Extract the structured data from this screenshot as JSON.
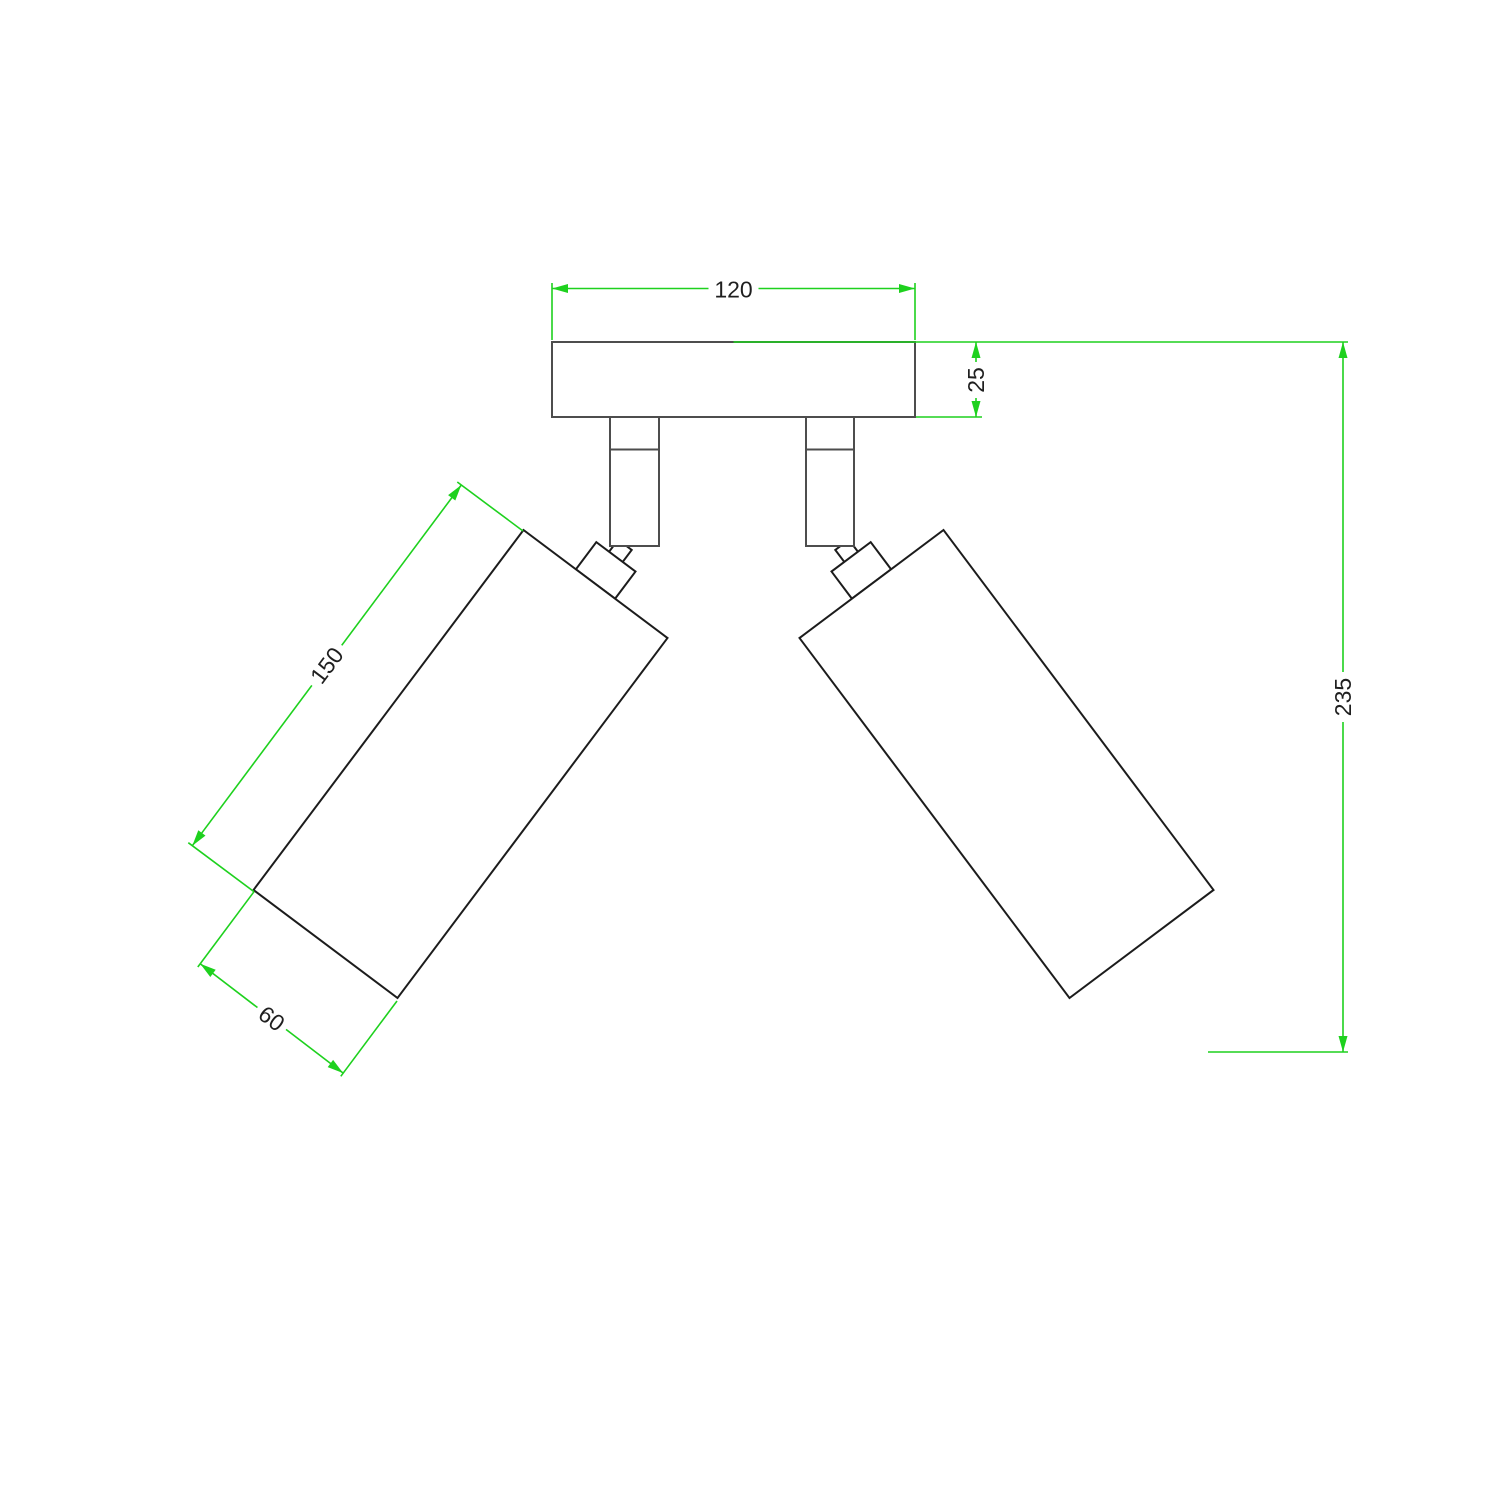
{
  "drawing": {
    "kind": "technical dimension drawing",
    "subject": "ceiling lamp with two adjustable cylindrical spotlights on a rectangular mounting plate",
    "units_shown": "none (plain numbers)",
    "dimensions": {
      "plate_width": "120",
      "plate_thickness": "25",
      "overall_height": "235",
      "spot_body_length": "150",
      "spot_body_diameter": "60"
    },
    "colors": {
      "dimension_green": "#1ed11e",
      "outline_dark": "#1c1c1c",
      "outline_gray": "#4d4d4d",
      "text_color": "#1f1f1f",
      "background": "#ffffff"
    }
  }
}
